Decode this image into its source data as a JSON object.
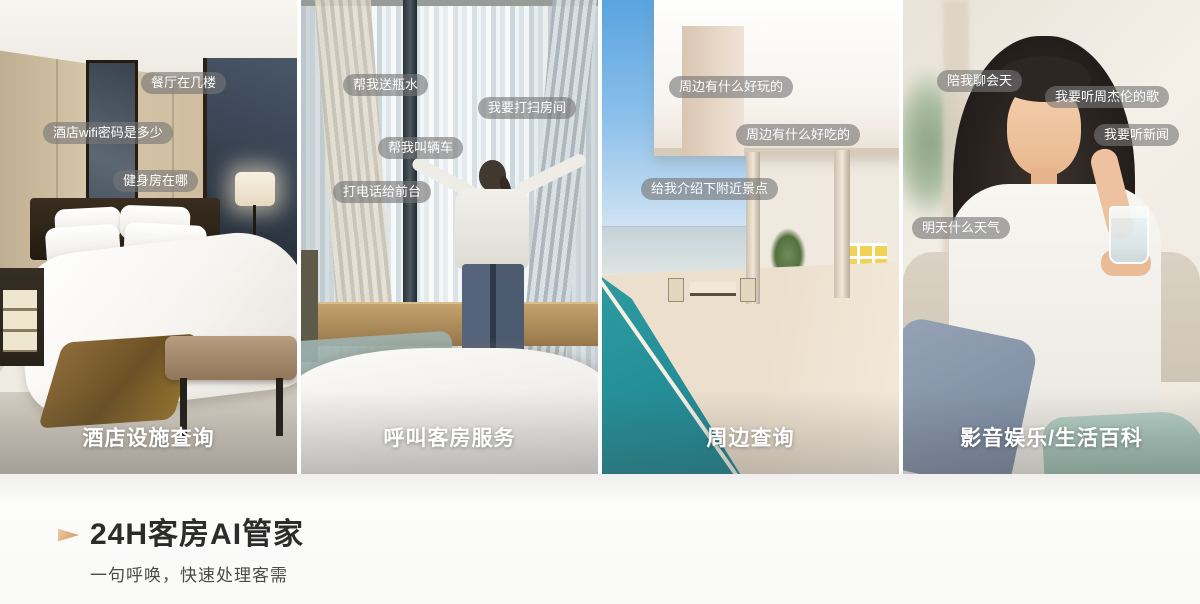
{
  "panels": [
    {
      "caption": "酒店设施查询",
      "scene": "hotel-bedroom-photo",
      "bubbles": [
        "餐厅在几楼",
        "酒店wifi密码是多少",
        "健身房在哪"
      ]
    },
    {
      "caption": "呼叫客房服务",
      "scene": "guest-at-window-photo",
      "bubbles": [
        "帮我送瓶水",
        "我要打扫房间",
        "帮我叫辆车",
        "打电话给前台"
      ]
    },
    {
      "caption": "周边查询",
      "scene": "seaside-villa-pool-photo",
      "bubbles": [
        "周边有什么好玩的",
        "周边有什么好吃的",
        "给我介绍下附近景点"
      ]
    },
    {
      "caption": "影音娱乐/生活百科",
      "scene": "woman-with-glass-photo",
      "bubbles": [
        "陪我聊会天",
        "我要听周杰伦的歌",
        "我要听新闻",
        "明天什么天气"
      ]
    }
  ],
  "footer": {
    "title": "24H客房AI管家",
    "subtitle": "一句呼唤，快速处理客需"
  },
  "colors": {
    "bubble_background": "rgba(118,118,118,0.62)",
    "bubble_text": "#ffffff",
    "caption_text": "#ffffff",
    "footer_title": "#2c2c2c",
    "footer_subtitle": "#4a4a4a",
    "accent_arrow": "#cb9160",
    "page_background": "#ffffff"
  }
}
